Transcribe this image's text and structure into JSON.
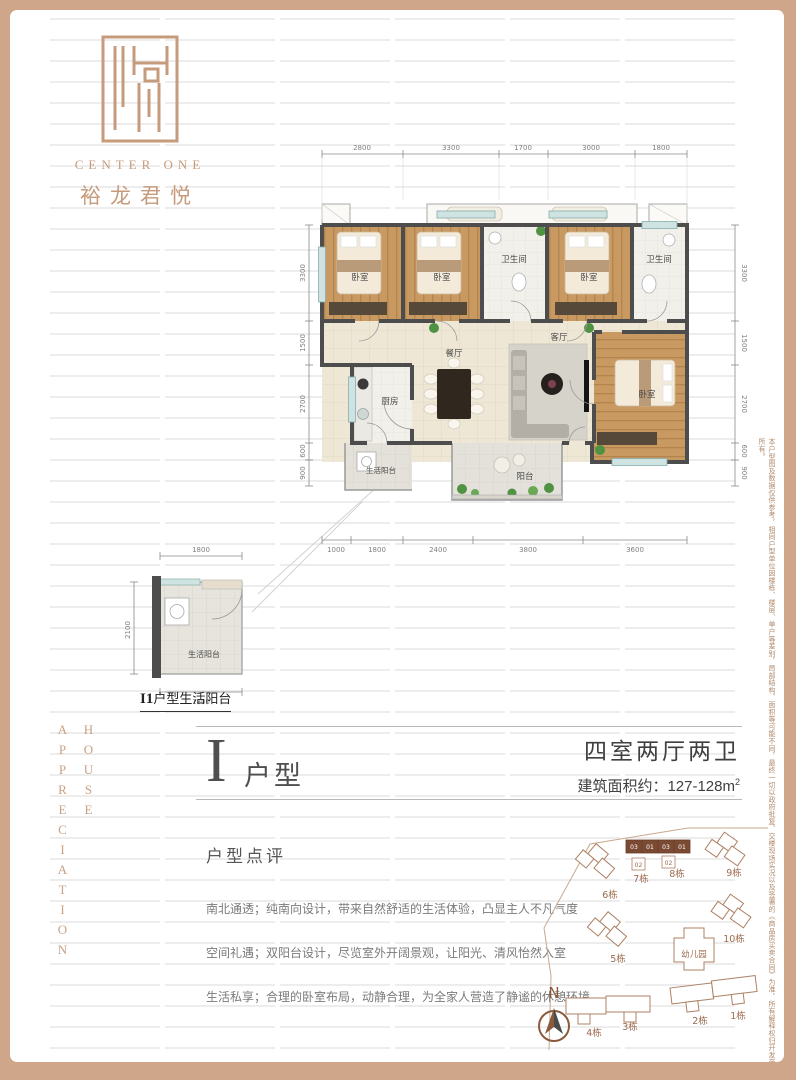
{
  "brand": {
    "logo_en": "CENTER ONE",
    "logo_cn": "裕龙君悦"
  },
  "sidebar": {
    "word1": "HOUSE",
    "word2": "APPRECIATION"
  },
  "floor_plan": {
    "dims_top": [
      "2800",
      "3300",
      "1700",
      "3000",
      "1800"
    ],
    "dims_bottom": [
      "1000",
      "1800",
      "2400",
      "3800",
      "3600"
    ],
    "dims_left": [
      "3300",
      "1500",
      "2700",
      "600",
      "900"
    ],
    "dims_right": [
      "3300",
      "1500",
      "2700",
      "600",
      "900"
    ],
    "rooms": {
      "bedroom": "卧室",
      "bathroom": "卫生间",
      "kitchen": "厨房",
      "dining": "餐厅",
      "living": "客厅",
      "balcony": "阳台",
      "service_balcony": "生活阳台"
    }
  },
  "detail_plan": {
    "dim_top": "1800",
    "dim_left": "2100",
    "dim_bottom": "1800",
    "room": "生活阳台",
    "caption_prefix": "I1",
    "caption_rest": "户型生活阳台"
  },
  "unit_info": {
    "letter": "I",
    "type_label": "户型",
    "layout": "四室两厅两卫",
    "area": "建筑面积约：127-128m",
    "area_sup": "2"
  },
  "review": {
    "title": "户型点评",
    "lines": [
      "南北通透；纯南向设计，带来自然舒适的生活体验，凸显主人不凡气度",
      "空间礼遇；双阳台设计，尽览室外开阔景观，让阳光、清风怡然入室",
      "生活私享；合理的卧室布局，动静合理，为全家人营造了静谧的休憩环境"
    ]
  },
  "site_plan": {
    "north": "N",
    "kindergarten": "幼儿园",
    "buildings": [
      "1栋",
      "2栋",
      "3栋",
      "4栋",
      "5栋",
      "6栋",
      "7栋",
      "8栋",
      "9栋",
      "10栋"
    ],
    "highlight_units": [
      "03",
      "01",
      "03",
      "01"
    ],
    "below_units": [
      "02",
      "02"
    ]
  },
  "disclaimer": "本户型图及数据仅供参考，相同户型单位因楼栋、楼层、单户等差别，局部结构、面积等可能不同，最终一切以政府批复、交楼现场实况以及签署的《商品房买卖合同》为准，所有解释权归开发商所有。",
  "colors": {
    "frame": "#cfa689",
    "accent": "#c69b7c",
    "plan_wall": "#4d4d4d",
    "site_brown": "#9c6b4f",
    "highlight_fill": "#7b4a33"
  }
}
